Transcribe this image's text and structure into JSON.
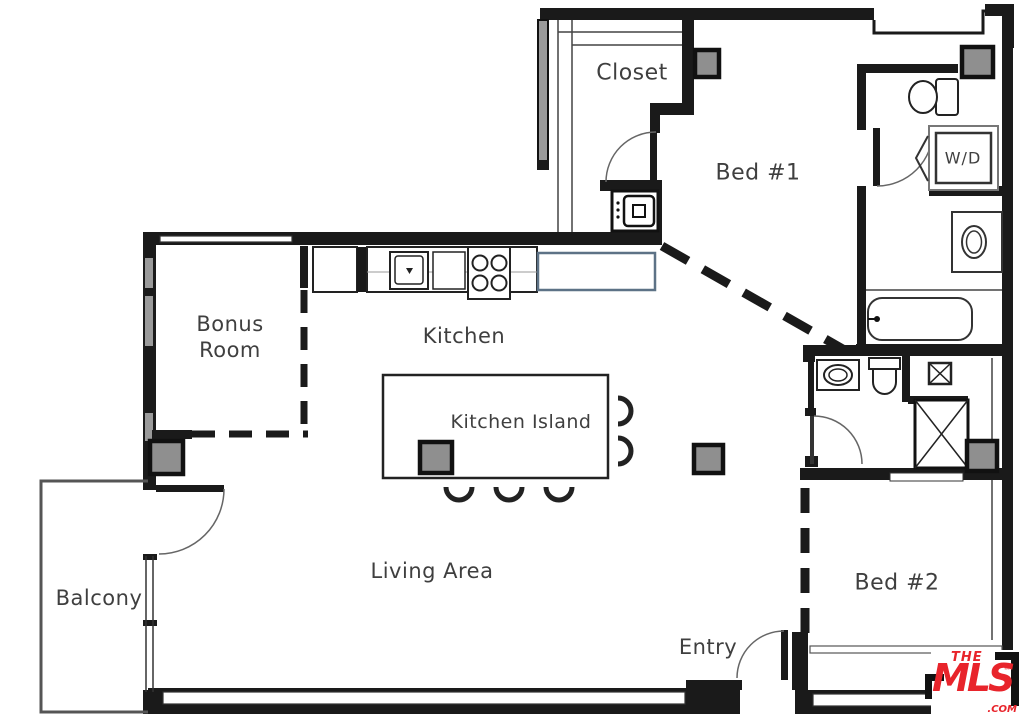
{
  "rooms": {
    "closet": "Closet",
    "bed1": "Bed #1",
    "bonus_line1": "Bonus",
    "bonus_line2": "Room",
    "kitchen": "Kitchen",
    "kitchen_island": "Kitchen Island",
    "living": "Living Area",
    "balcony": "Balcony",
    "entry": "Entry",
    "bed2": "Bed #2"
  },
  "fixtures": {
    "washer_dryer": "W/D"
  },
  "logo": {
    "line1": "THE",
    "line2": "MLS",
    "tm": "™",
    "suffix": ".COM"
  },
  "colors": {
    "wall": "#1a1a1a",
    "column_fill": "#8f8f8f",
    "fridge_outline": "#5d7286",
    "logo_red": "#e8242b",
    "label_text": "#3f3f3f"
  }
}
